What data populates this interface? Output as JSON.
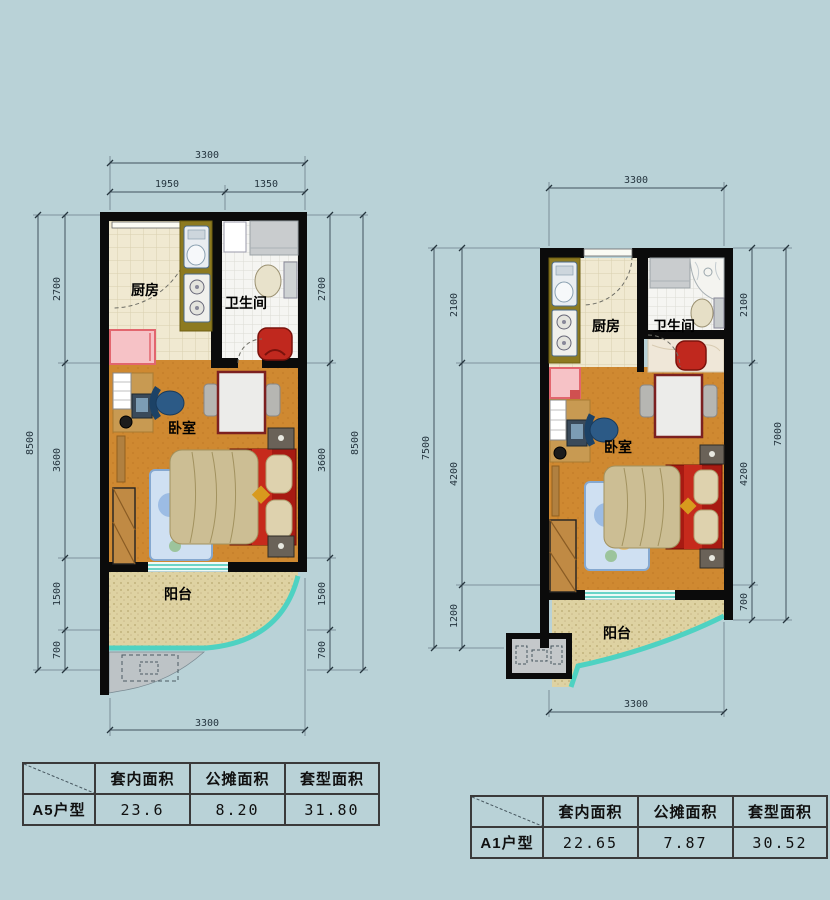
{
  "palette": {
    "background": "#b9d2d7",
    "wall": "#0b0b0b",
    "kitchen_floor": "#f0e9d1",
    "bath_floor": "#f5f5f2",
    "bedroom_floor": "#cf8931",
    "balcony_floor": "#ded2a2",
    "balcony_glass": "#4ed2c2",
    "counter_olive": "#8d7a20",
    "accent_red": "#c0281e",
    "cabinet_pink": "#f6c2c6"
  },
  "plan_a5": {
    "rooms": {
      "kitchen": "厨房",
      "bathroom": "卫生间",
      "bedroom": "卧室",
      "balcony": "阳台"
    },
    "dims": {
      "top_total": "3300",
      "top_left": "1950",
      "top_right": "1350",
      "left_total": "8500",
      "left_seg1": "2700",
      "left_seg2": "3600",
      "left_seg3": "1500",
      "left_seg4": "700",
      "right_seg1": "2700",
      "right_seg2": "3600",
      "right_seg3": "1500",
      "right_seg4": "700",
      "right_total": "8500",
      "bottom_total": "3300"
    }
  },
  "plan_a1": {
    "rooms": {
      "kitchen": "厨房",
      "bathroom": "卫生间",
      "bedroom": "卧室",
      "balcony": "阳台"
    },
    "dims": {
      "top_total": "3300",
      "left_total": "7500",
      "left_seg1": "2100",
      "left_seg2": "4200",
      "left_seg3": "1200",
      "right_seg1": "2100",
      "right_seg2": "4200",
      "right_seg3": "700",
      "right_total": "7000",
      "bottom_total": "3300"
    }
  },
  "table_a5": {
    "unit": "A5户型",
    "col1": "套内面积",
    "col2": "公摊面积",
    "col3": "套型面积",
    "val1": "23.6",
    "val2": "8.20",
    "val3": "31.80"
  },
  "table_a1": {
    "unit": "A1户型",
    "col1": "套内面积",
    "col2": "公摊面积",
    "col3": "套型面积",
    "val1": "22.65",
    "val2": "7.87",
    "val3": "30.52"
  }
}
